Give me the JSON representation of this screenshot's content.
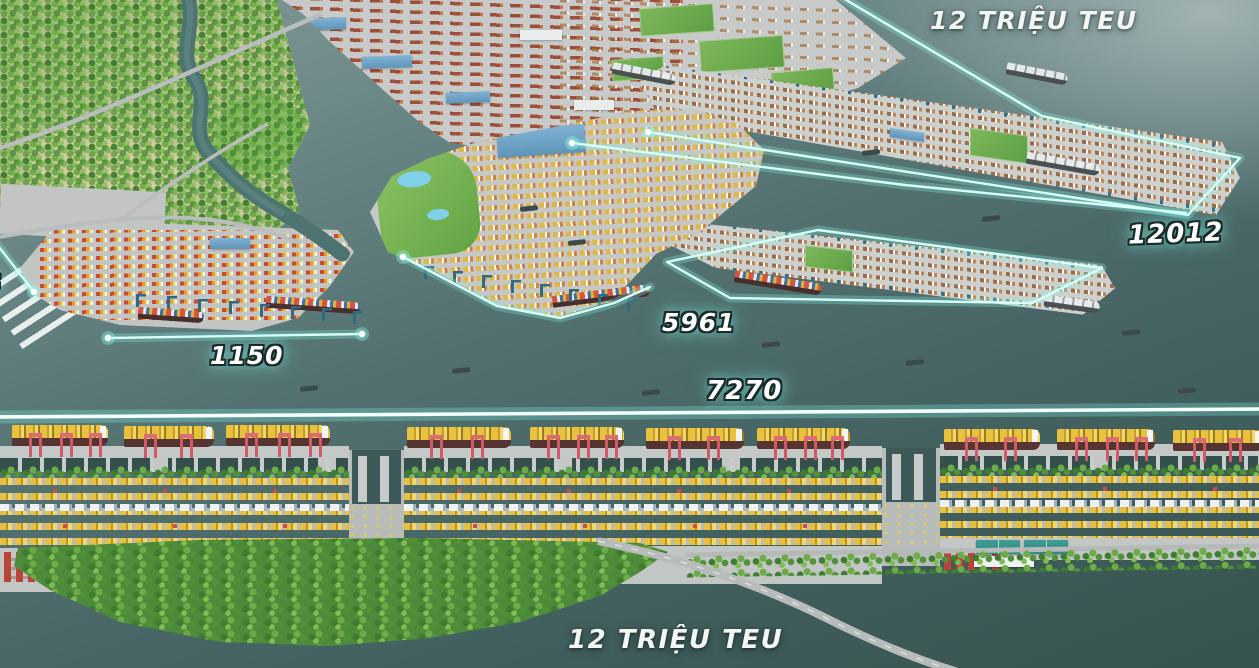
{
  "labels": {
    "capacity_top": "12 TRIỆU TEU",
    "capacity_bottom": "12 TRIỆU TEU",
    "berth_length_right": "12012",
    "berth_length_mid": "5961",
    "berth_length_left": "1150",
    "berth_length_main": "7270",
    "partial_left_edge": "6"
  },
  "colors": {
    "measurement_line": "#d9fff8",
    "water_deep": "#37534f",
    "water_light": "#87999a",
    "container_yellow": "#e5c043",
    "crane_red": "#d05a65",
    "crane_blue": "#2f6b82",
    "tree_green": "#4f9238"
  }
}
